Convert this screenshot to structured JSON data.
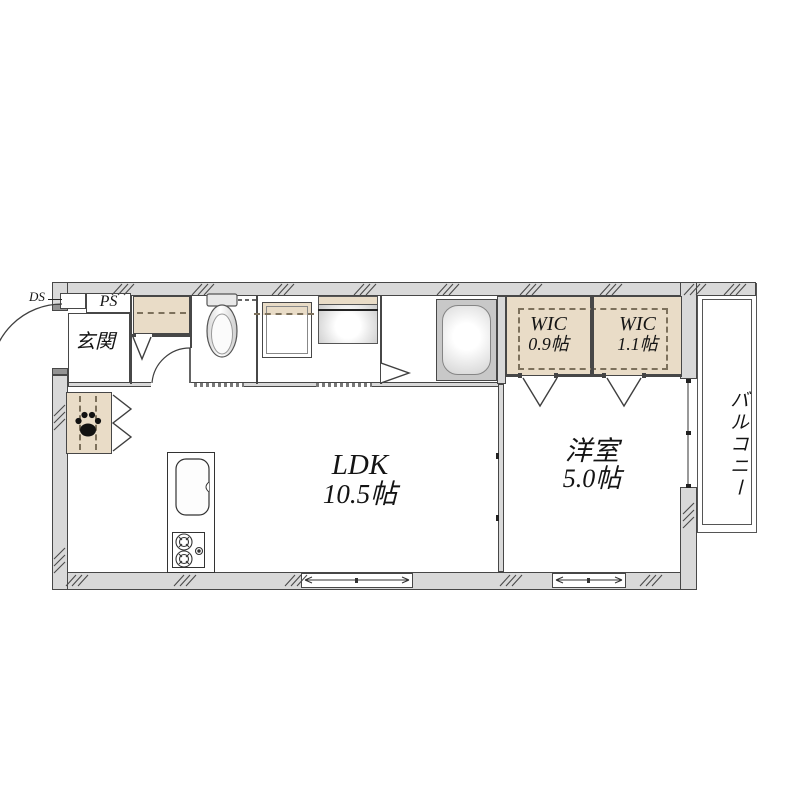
{
  "rooms": {
    "entrance": {
      "label": "玄関"
    },
    "pipe_space": {
      "label": "PS"
    },
    "duct_space": {
      "label": "DS"
    },
    "ldk": {
      "name": "LDK",
      "size": "10.5帖"
    },
    "western_room": {
      "name": "洋室",
      "size": "5.0帖"
    },
    "wic_left": {
      "name": "WIC",
      "size": "0.9帖"
    },
    "wic_right": {
      "name": "WIC",
      "size": "1.1帖"
    },
    "balcony": {
      "label": "バルコニー"
    }
  },
  "icons": {
    "toilet": "toilet-icon",
    "bathtub": "bathtub-icon",
    "washer": "washing-machine-space-icon",
    "vanity": "washbasin-icon",
    "kitchen": "kitchen-counter-icon",
    "stove": "gas-stove-icon",
    "paw": "paw-print-icon"
  },
  "colors": {
    "wall_fill": "#d9d9d9",
    "wall_line": "#474747",
    "closet_fill": "#e9dcc7",
    "dash_color": "#7d715c",
    "fixture_gray": "#c8c8c8",
    "background": "#ffffff"
  }
}
